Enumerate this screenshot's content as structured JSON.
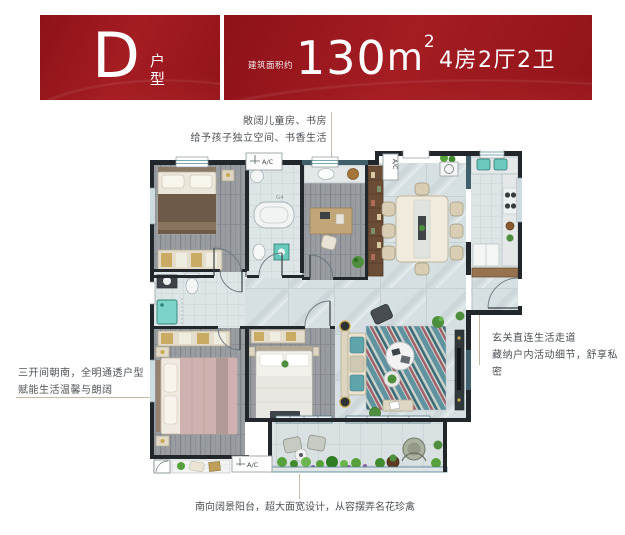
{
  "header": {
    "unit_letter": "D",
    "unit_type_label": "户型",
    "area_prefix": "建筑面积约",
    "area_value": "130",
    "area_unit": "m",
    "area_sup": "2",
    "rooms_label": "4房2厅2卫",
    "accent_red": "#9c171d"
  },
  "annotations": {
    "top": {
      "line1": "敞阔儿童房、书房",
      "line2": "给予孩子独立空间、书香生活"
    },
    "left": {
      "line1": "三开间朝南，全明通透户型",
      "line2": "赋能生活温馨与朗阔"
    },
    "right": {
      "line1": "玄关直连生活走道",
      "line2": "藏纳户内活动细节，舒享私密"
    },
    "bottom": {
      "line1": "南向阔景阳台，超大面宽设计，从容摆弄名花珍禽"
    }
  },
  "plan": {
    "labels": {
      "ac_top": "A/C",
      "ac_side": "A/C",
      "ac_bottom": "A/C",
      "window_code": "G4"
    },
    "colors": {
      "wall": "#21272b",
      "wood_floor": "#999da1",
      "marble_floor": "#d6dfe1",
      "tile_floor": "#dee5e7",
      "window_teal": "#4f8a96",
      "leader_line": "#c6baa6"
    }
  }
}
